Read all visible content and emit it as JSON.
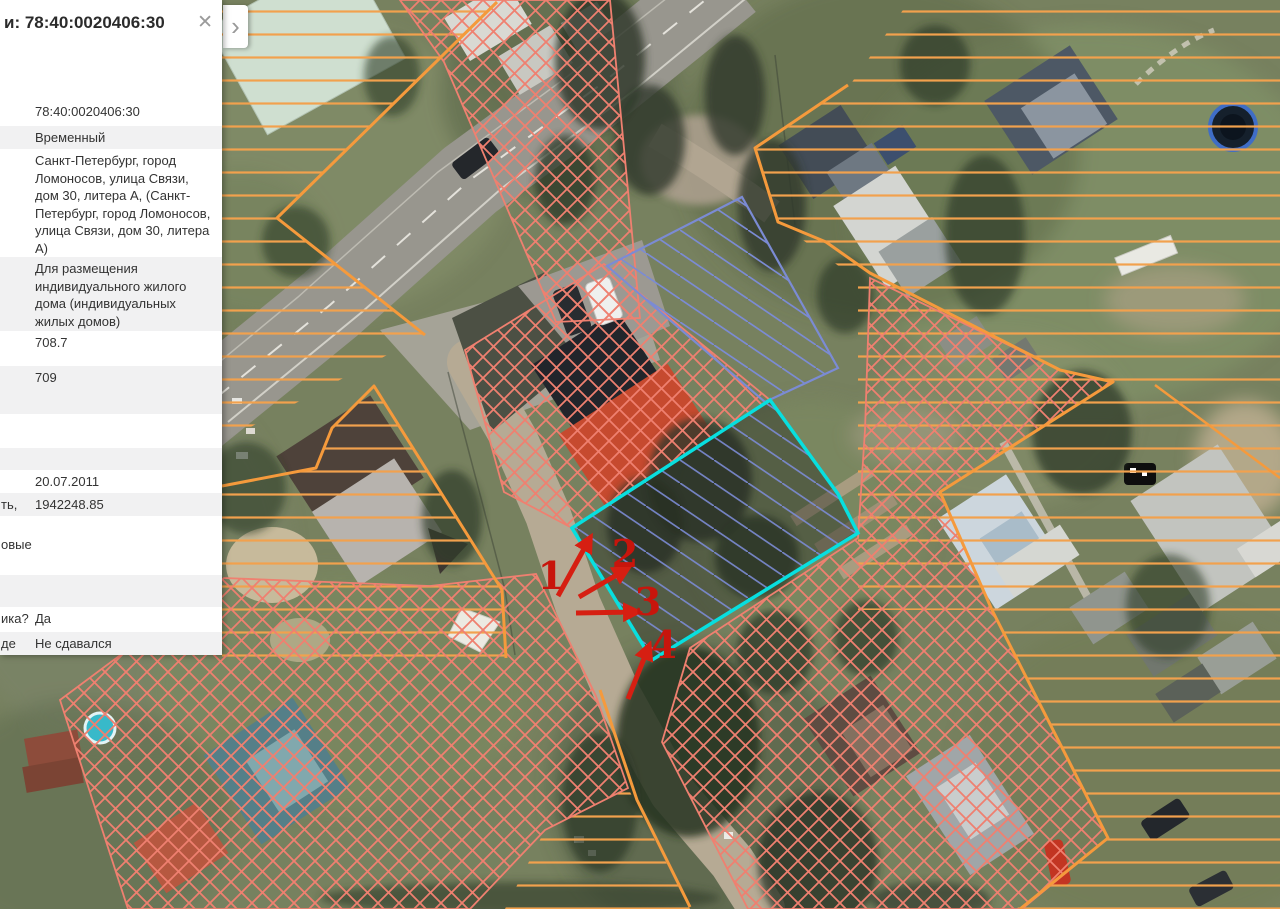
{
  "panel": {
    "title": "и: 78:40:0020406:30",
    "close_icon": "✕",
    "expand_icon": "›",
    "rows": [
      {
        "label": "",
        "value": "78:40:0020406:30"
      },
      {
        "label": "",
        "value": "Временный"
      },
      {
        "label": "",
        "value": "Санкт-Петербург, город Ломоносов, улица Связи, дом 30, литера А, (Санкт-Петербург, город Ломоносов, улица Связи, дом 30, литера А)"
      },
      {
        "label": "",
        "value": "Для размещения индивидуального жилого дома (индивидуальных жилых домов)"
      },
      {
        "label": "",
        "value": "708.7"
      },
      {
        "label": "",
        "value": "709"
      },
      {
        "label": "",
        "value": ""
      },
      {
        "label": "",
        "value": ""
      },
      {
        "label": "",
        "value": "20.07.2011"
      },
      {
        "label": "ть,",
        "value": "1942248.85"
      },
      {
        "label": "",
        "value": ""
      },
      {
        "label": "овые",
        "value": ""
      },
      {
        "label": "",
        "value": ""
      },
      {
        "label": "",
        "value": ""
      },
      {
        "label": "ика?",
        "value": "Да"
      },
      {
        "label": "де",
        "value": "Не сдавался"
      }
    ]
  },
  "map": {
    "annotations": [
      {
        "n": "1"
      },
      {
        "n": "2"
      },
      {
        "n": "3"
      },
      {
        "n": "4"
      }
    ],
    "colors": {
      "selected_parcel_outline": "#08dfdf",
      "blue_parcel_hatch": "#7b8bd4",
      "red_parcel_hatch": "#ef8070",
      "orange_zone_lines": "#f2a14d",
      "orange_boundary": "#f59a3c",
      "annotation_arrows": "#d61f12"
    }
  }
}
